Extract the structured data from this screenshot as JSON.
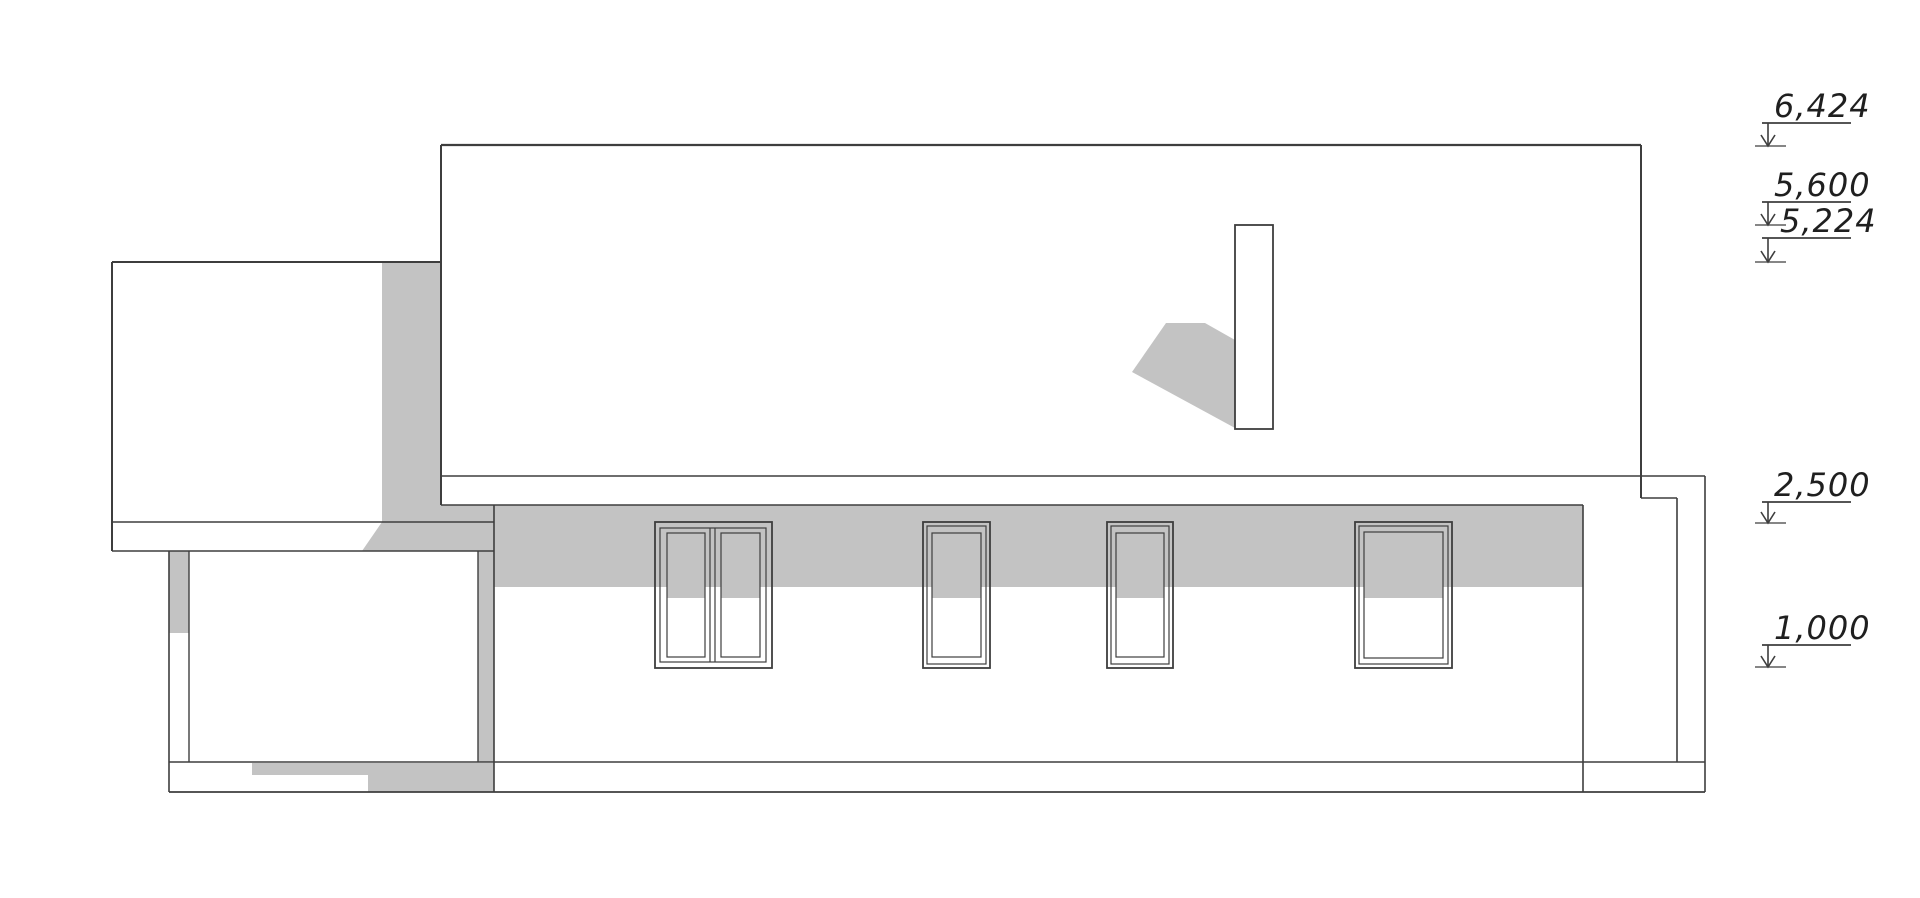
{
  "drawing": {
    "kind": "architectural side elevation of a house, black line drawing with flat gray cast shadows on white",
    "features": {
      "main_roof_block": "large white rectangle, upper center-right",
      "chimney": "small vertical rectangle on roof with gray cast shadow to its lower-left",
      "garage_block": "lower flat-roof block on the left with carport opening below",
      "veranda_frame": "open post-and-beam frame on the right end",
      "windows": [
        "double casement",
        "single casement",
        "single casement",
        "wide single casement"
      ],
      "shadow_band": "gray eave shadow across the wall and upper part of window glazing",
      "plinth": "base strip along the bottom with partial gray shadow at left"
    }
  },
  "colors": {
    "line": "#3e3e3e",
    "shadow": "#c3c3c3",
    "text": "#1f1f1f",
    "bg": "#ffffff"
  },
  "levels": [
    {
      "label": "6,424"
    },
    {
      "label": "5,600"
    },
    {
      "label": "5,224"
    },
    {
      "label": "2,500"
    },
    {
      "label": "1,000"
    }
  ]
}
